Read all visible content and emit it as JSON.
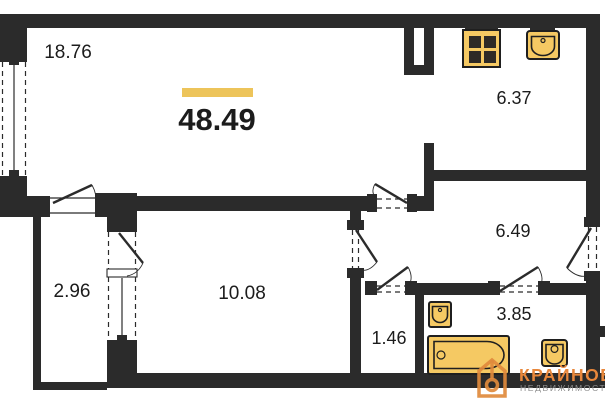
{
  "plan": {
    "total_area": "48.49",
    "rooms": [
      {
        "name": "living-room",
        "area": "18.76"
      },
      {
        "name": "kitchen",
        "area": "6.37"
      },
      {
        "name": "hallway",
        "area": "6.49"
      },
      {
        "name": "room",
        "area": "10.08"
      },
      {
        "name": "loggia",
        "area": "2.96"
      },
      {
        "name": "storage",
        "area": "1.46"
      },
      {
        "name": "bathroom",
        "area": "3.85"
      }
    ],
    "fixtures": [
      "stove-icon",
      "kitchen-sink-icon",
      "bathroom-sink-icon",
      "bathtub-icon",
      "toilet-icon"
    ]
  },
  "logo": {
    "brand": "КРАЙНОВ",
    "subtitle": "НЕДВИЖИМОСТЬ"
  },
  "colors": {
    "wall": "#2b2b2b",
    "fixture_fill": "#F5C963",
    "highlight_bar": "#EDC45A",
    "logo_accent": "#E8873B",
    "logo_subtitle": "#8f8f8f",
    "background": "#ffffff"
  }
}
